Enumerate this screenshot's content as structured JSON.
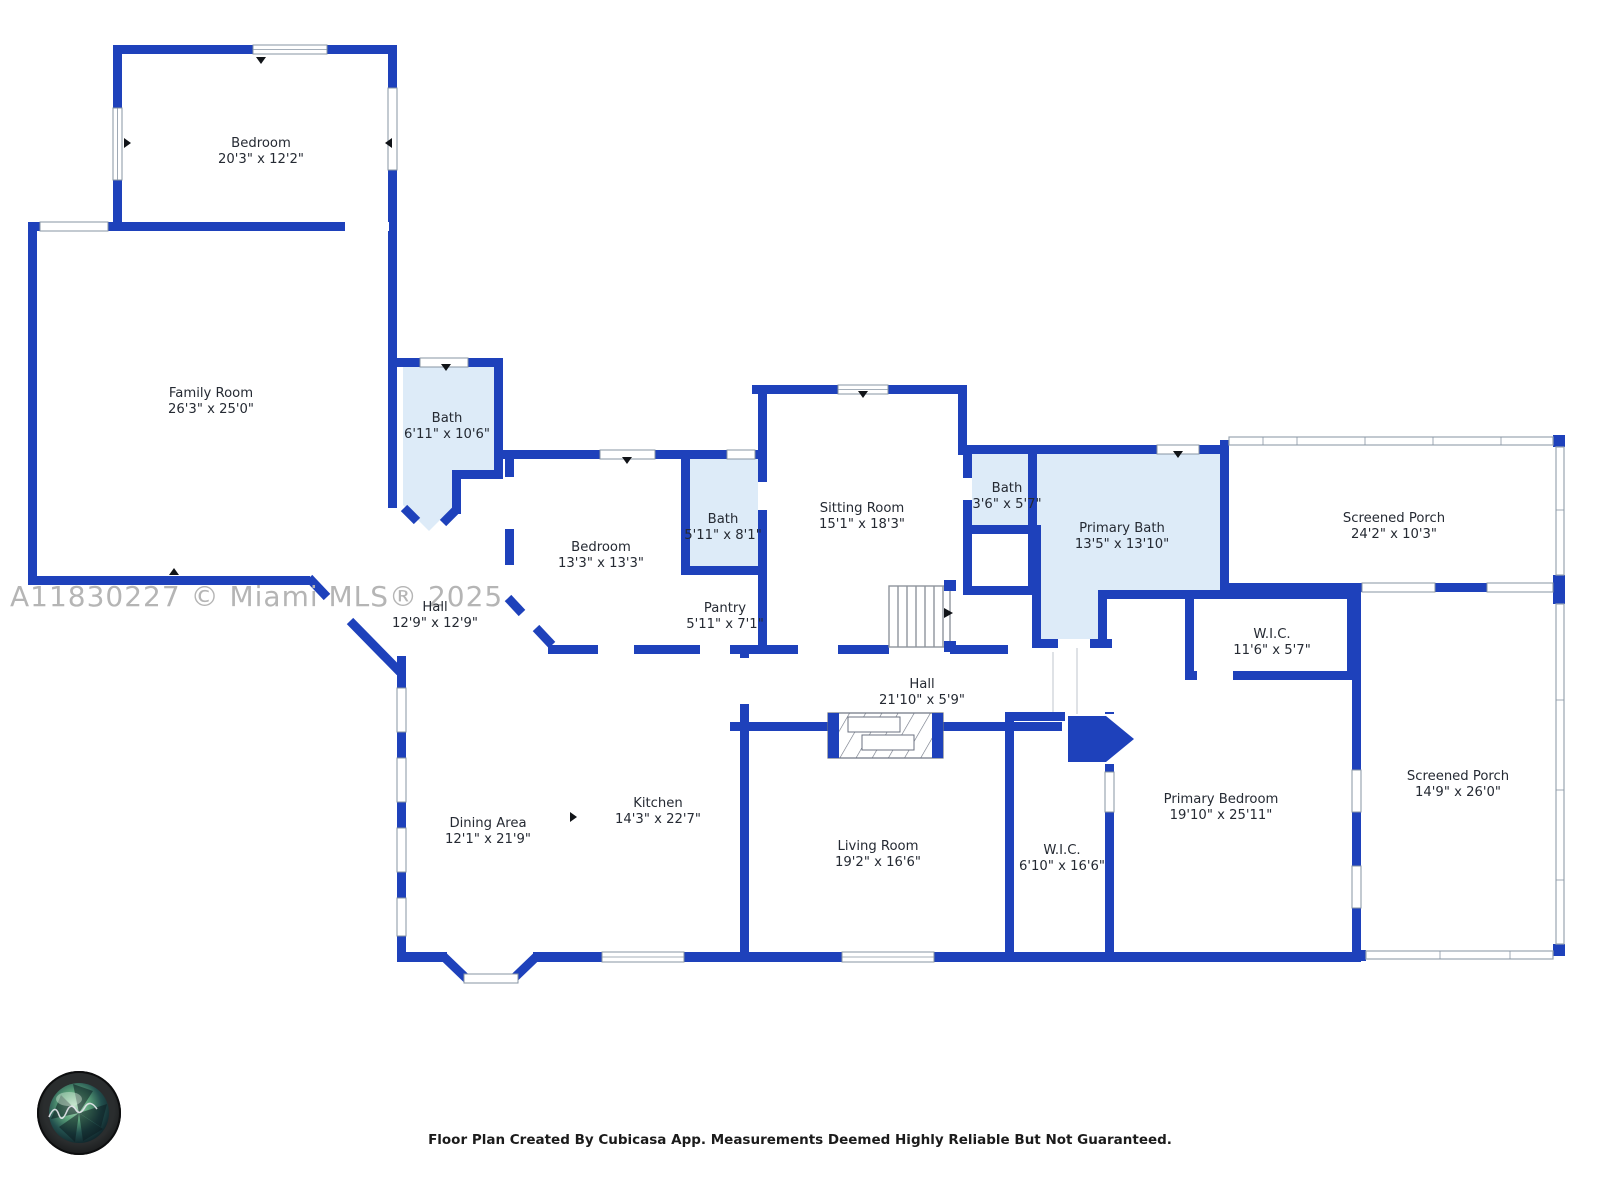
{
  "watermark": "A11830227 © Miami MLS® 2025",
  "footer": "Floor Plan Created By Cubicasa App. Measurements Deemed Highly Reliable But Not Guaranteed.",
  "colors": {
    "wall_blue": "#1e41bb",
    "bath_fill": "#ddebf8",
    "label_text": "#252a33",
    "watermark_gray": "#b5b5b5",
    "window_frame": "#8794a3"
  },
  "rooms": [
    {
      "id": "bedroom-top",
      "name": "Bedroom",
      "dims": "20'3\" x 12'2\"",
      "x": 261,
      "y": 147
    },
    {
      "id": "family-room",
      "name": "Family Room",
      "dims": "26'3\" x 25'0\"",
      "x": 211,
      "y": 397
    },
    {
      "id": "bath-1",
      "name": "Bath",
      "dims": "6'11\" x 10'6\"",
      "x": 447,
      "y": 422
    },
    {
      "id": "bedroom-2",
      "name": "Bedroom",
      "dims": "13'3\" x 13'3\"",
      "x": 601,
      "y": 551
    },
    {
      "id": "bath-2",
      "name": "Bath",
      "dims": "5'11\" x 8'1\"",
      "x": 723,
      "y": 523
    },
    {
      "id": "pantry",
      "name": "Pantry",
      "dims": "5'11\" x 7'1\"",
      "x": 725,
      "y": 612
    },
    {
      "id": "sitting-room",
      "name": "Sitting Room",
      "dims": "15'1\" x 18'3\"",
      "x": 862,
      "y": 512
    },
    {
      "id": "bath-3",
      "name": "Bath",
      "dims": "3'6\" x 5'7\"",
      "x": 1007,
      "y": 492
    },
    {
      "id": "primary-bath",
      "name": "Primary Bath",
      "dims": "13'5\" x 13'10\"",
      "x": 1122,
      "y": 532
    },
    {
      "id": "screened-porch-top",
      "name": "Screened Porch",
      "dims": "24'2\" x 10'3\"",
      "x": 1394,
      "y": 522
    },
    {
      "id": "hall-1",
      "name": "Hall",
      "dims": "12'9\" x 12'9\"",
      "x": 435,
      "y": 611
    },
    {
      "id": "wic-1",
      "name": "W.I.C.",
      "dims": "11'6\" x 5'7\"",
      "x": 1272,
      "y": 638
    },
    {
      "id": "hall-2",
      "name": "Hall",
      "dims": "21'10\" x 5'9\"",
      "x": 922,
      "y": 688
    },
    {
      "id": "dining-area",
      "name": "Dining Area",
      "dims": "12'1\" x 21'9\"",
      "x": 488,
      "y": 827
    },
    {
      "id": "kitchen",
      "name": "Kitchen",
      "dims": "14'3\" x 22'7\"",
      "x": 658,
      "y": 807
    },
    {
      "id": "living-room",
      "name": "Living Room",
      "dims": "19'2\" x 16'6\"",
      "x": 878,
      "y": 850
    },
    {
      "id": "wic-2",
      "name": "W.I.C.",
      "dims": "6'10\" x 16'6\"",
      "x": 1062,
      "y": 854
    },
    {
      "id": "primary-bedroom",
      "name": "Primary Bedroom",
      "dims": "19'10\" x 25'11\"",
      "x": 1221,
      "y": 803
    },
    {
      "id": "screened-porch-right",
      "name": "Screened Porch",
      "dims": "14'9\" x 26'0\"",
      "x": 1458,
      "y": 780
    }
  ]
}
